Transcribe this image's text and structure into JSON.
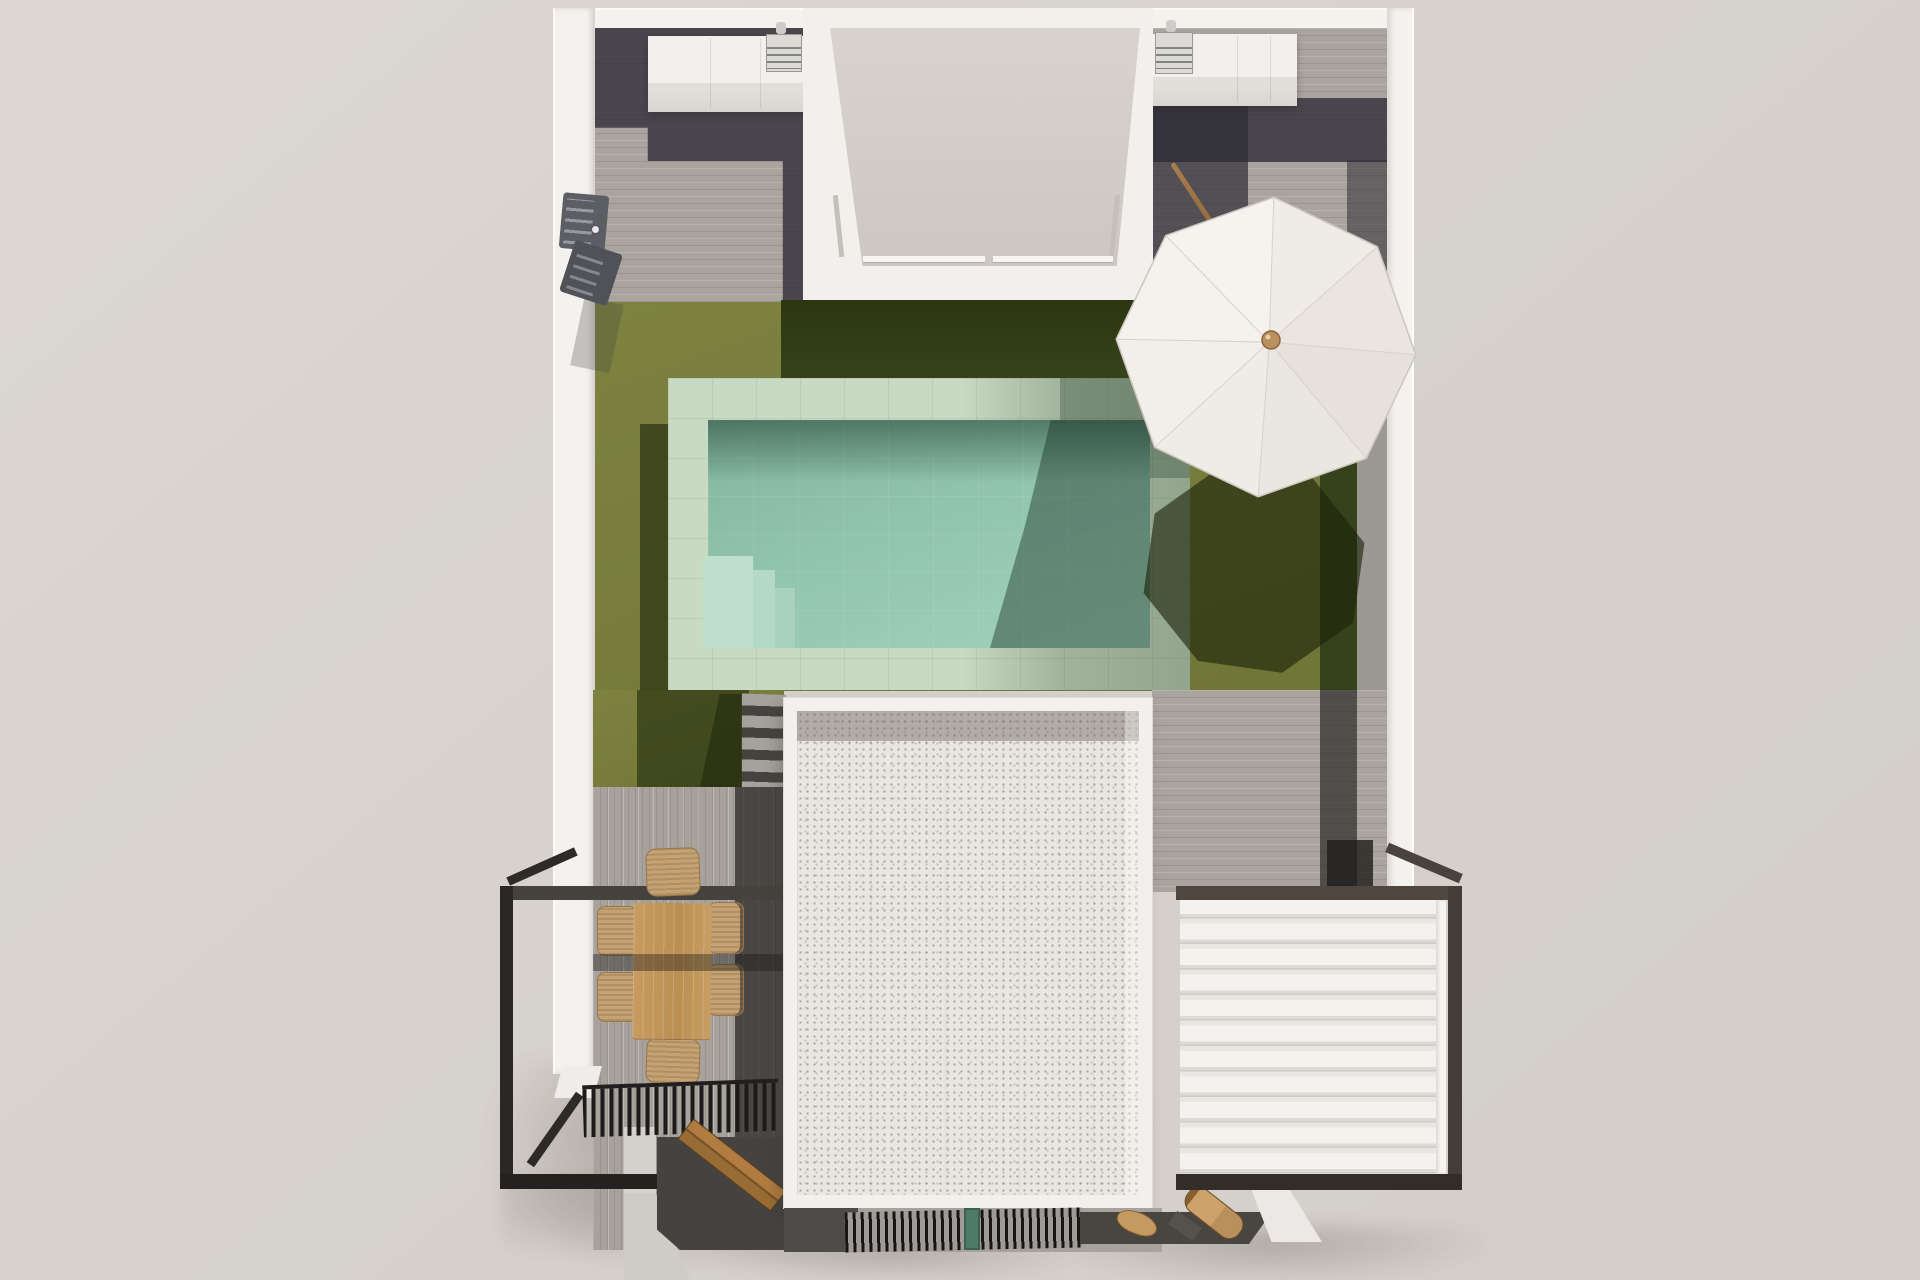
{
  "scene": {
    "title": "Top-down 3D architectural render of a villa plot with roof terrace, garden, pool and pergolas",
    "view": "bird's-eye / top-down",
    "medium": "photorealistic 3D visualization",
    "no_visible_text": true
  },
  "palette": {
    "background": "#d8d3cf",
    "white_walls": "#f4f2ef",
    "wood_deck_light": "#aaa49e",
    "wood_deck_shadow": "#4a4744",
    "lawn_sunlit": "#777c3b",
    "lawn_shadow": "#36421a",
    "pool_deck_stone": "#c9dac2",
    "pool_water": "#93c6ae",
    "pool_water_shadow": "#57806d",
    "roof_gravel": "#e9e6e2",
    "metal_frame_black": "#2a2724",
    "pergola_frame_gray": "#4a423c",
    "louver_white": "#f4f2ef",
    "furniture_wood": "#c89c60",
    "wicker_chair": "#c4a273",
    "umbrella_canopy": "#f0ece7",
    "umbrella_knob": "#ba9061",
    "vent_teal": "#4e7a6a"
  },
  "objects": [
    {
      "name": "boundary-walls",
      "description": "white perimeter walls of the plot"
    },
    {
      "name": "outdoor-kitchen-left",
      "description": "white counter with small sink/grill appliance, top-left wing"
    },
    {
      "name": "outdoor-kitchen-right",
      "description": "white counter with small sink/grill appliance, top-right wing"
    },
    {
      "name": "courtyard-lightwell",
      "description": "recessed courtyard with glass railing between the two top wings"
    },
    {
      "name": "lawn",
      "description": "olive-green artificial lawn with cast building shadows"
    },
    {
      "name": "swimming-pool",
      "description": "rectangular pool with pale stone surround and corner steps"
    },
    {
      "name": "patio-umbrella",
      "description": "white octagonal parasol with wooden hub and its shadow on the lawn"
    },
    {
      "name": "garden-stairs",
      "description": "gray steps from pool deck down to lower terrace"
    },
    {
      "name": "gravel-roof",
      "description": "large white gravel flat roof with parapet"
    },
    {
      "name": "louvered-pergola",
      "description": "bioclimatic pergola with white louvers and dark frame, bottom right"
    },
    {
      "name": "balcony-frame",
      "description": "black steel balcony frame, bottom left"
    },
    {
      "name": "dining-set",
      "description": "wooden table with six wicker chairs on gray wood deck"
    },
    {
      "name": "slatted-grill",
      "description": "black slatted shade band over lower terrace"
    },
    {
      "name": "wood-bench",
      "description": "angled wooden bench on shaded deck"
    },
    {
      "name": "ventilation-grate",
      "description": "black grate strip with teal vent at bottom of the roof"
    },
    {
      "name": "outdoor-shower",
      "description": "dark gray shower column on the left wall"
    },
    {
      "name": "surfboard-and-paddle",
      "description": "small wooden boards on the bottom-right deck"
    }
  ]
}
